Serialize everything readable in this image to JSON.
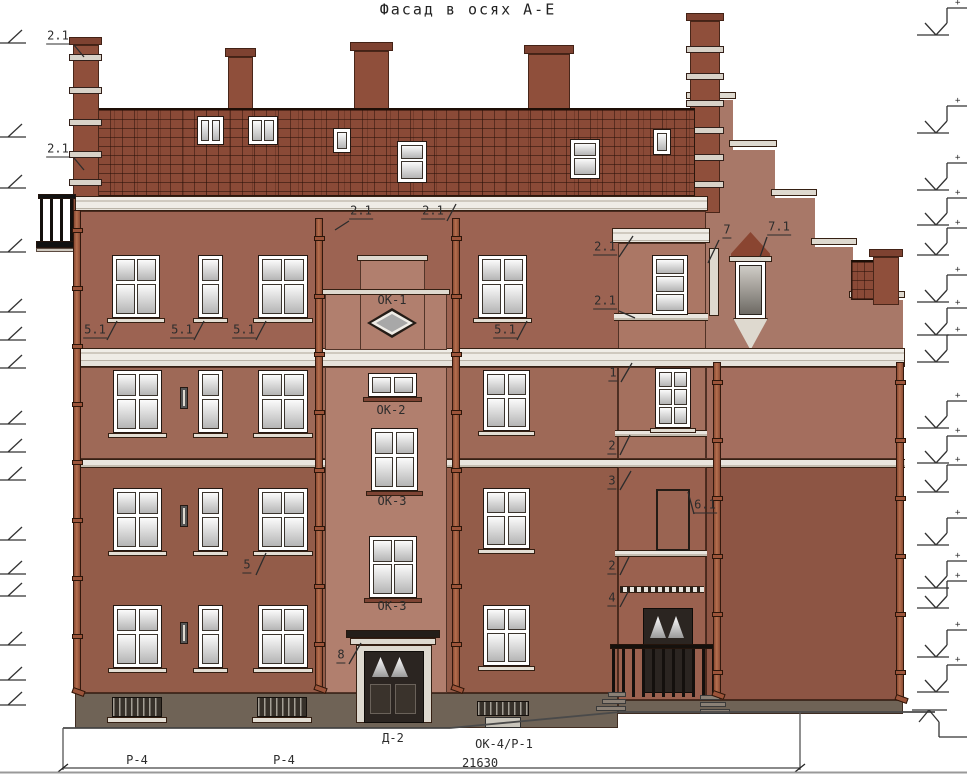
{
  "title": "Фасад в осях А-Е",
  "marks_plus_symbol": "+",
  "dimension_total": "21630",
  "colors": {
    "roof": "#8a4a37",
    "wall_attic": "#9c6352",
    "wall_mid": "#9e6957",
    "wall_lower": "#935c49",
    "tower": "#b17f6e",
    "bay_top": "#ab7765",
    "bay_mid": "#a4705e",
    "bay_lower": "#9a614f",
    "right_top": "#a46e5e",
    "right_bottom": "#8d5544",
    "gable": "#a87868",
    "plinth": "#6f6356",
    "cornice": "#e9e6e0",
    "pipe": "#a05c42",
    "door": "#2b2521",
    "line": "#2c2c2c"
  },
  "callouts": [
    {
      "text": "2.1",
      "x": 58,
      "y": 37,
      "lx": 74,
      "ly": 45,
      "tx": 84,
      "ty": 57
    },
    {
      "text": "2.1",
      "x": 58,
      "y": 150,
      "lx": 74,
      "ly": 158,
      "tx": 84,
      "ty": 170
    },
    {
      "text": "2.1",
      "x": 361,
      "y": 212,
      "lx": 349,
      "ly": 221,
      "tx": 335,
      "ty": 230
    },
    {
      "text": "2.1",
      "x": 433,
      "y": 212,
      "lx": 447,
      "ly": 221,
      "tx": 456,
      "ty": 204
    },
    {
      "text": "2.1",
      "x": 605,
      "y": 248,
      "lx": 619,
      "ly": 257,
      "tx": 633,
      "ty": 236
    },
    {
      "text": "2.1",
      "x": 605,
      "y": 302,
      "lx": 619,
      "ly": 311,
      "tx": 635,
      "ty": 318
    },
    {
      "text": "7",
      "x": 727,
      "y": 231,
      "lx": 719,
      "ly": 240,
      "tx": 708,
      "ty": 263
    },
    {
      "text": "7.1",
      "x": 779,
      "y": 228,
      "lx": 767,
      "ly": 237,
      "tx": 760,
      "ty": 257
    },
    {
      "text": "5.1",
      "x": 95,
      "y": 331,
      "lx": 107,
      "ly": 340,
      "tx": 117,
      "ty": 321
    },
    {
      "text": "5.1",
      "x": 182,
      "y": 331,
      "lx": 194,
      "ly": 340,
      "tx": 204,
      "ty": 321
    },
    {
      "text": "5.1",
      "x": 244,
      "y": 331,
      "lx": 256,
      "ly": 340,
      "tx": 266,
      "ty": 321
    },
    {
      "text": "5.1",
      "x": 505,
      "y": 331,
      "lx": 517,
      "ly": 340,
      "tx": 527,
      "ty": 321
    },
    {
      "text": "5",
      "x": 247,
      "y": 566,
      "lx": 256,
      "ly": 575,
      "tx": 266,
      "ty": 553
    },
    {
      "text": "1",
      "x": 613,
      "y": 374,
      "lx": 621,
      "ly": 382,
      "tx": 632,
      "ty": 363
    },
    {
      "text": "2",
      "x": 612,
      "y": 447,
      "lx": 620,
      "ly": 455,
      "tx": 630,
      "ty": 435
    },
    {
      "text": "3",
      "x": 612,
      "y": 482,
      "lx": 620,
      "ly": 490,
      "tx": 631,
      "ty": 471
    },
    {
      "text": "6.1",
      "x": 705,
      "y": 506,
      "lx": 694,
      "ly": 514,
      "tx": 688,
      "ty": 492
    },
    {
      "text": "2",
      "x": 612,
      "y": 567,
      "lx": 620,
      "ly": 575,
      "tx": 629,
      "ty": 557
    },
    {
      "text": "4",
      "x": 612,
      "y": 599,
      "lx": 620,
      "ly": 607,
      "tx": 628,
      "ty": 592
    },
    {
      "text": "8",
      "x": 341,
      "y": 656,
      "lx": 349,
      "ly": 664,
      "tx": 361,
      "ty": 643
    }
  ],
  "part_labels": [
    {
      "text": "ОК-1",
      "x": 392,
      "y": 300
    },
    {
      "text": "ОК-2",
      "x": 391,
      "y": 410
    },
    {
      "text": "ОК-3",
      "x": 392,
      "y": 501
    },
    {
      "text": "ОК-3",
      "x": 392,
      "y": 606
    },
    {
      "text": "Д-2",
      "x": 393,
      "y": 738
    },
    {
      "text": "ОК-4/Р-1",
      "x": 504,
      "y": 744
    },
    {
      "text": "Р-4",
      "x": 137,
      "y": 760
    },
    {
      "text": "Р-4",
      "x": 284,
      "y": 760
    },
    {
      "text": "21630",
      "x": 480,
      "y": 763
    }
  ]
}
